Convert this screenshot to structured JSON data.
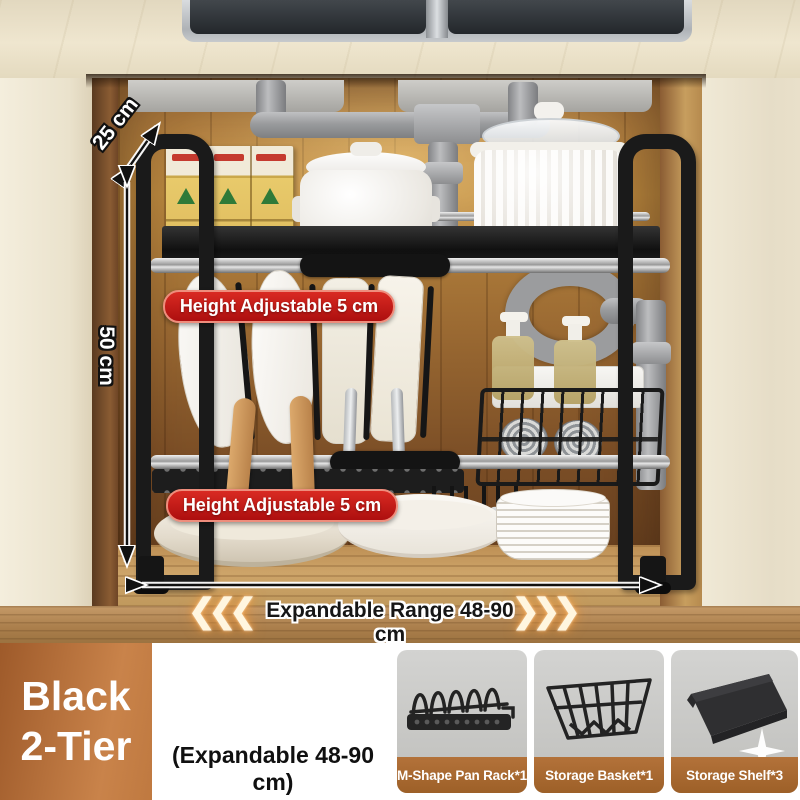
{
  "annotations": {
    "depth_label": "25 cm",
    "height_label": "50 ccm_fix",
    "tier1_badge": "Height Adjustable 5 cm",
    "tier2_badge": "Height Adjustable 5 cm",
    "expand_label": "Expandable Range 48-90 cm",
    "chevrons_left": "❮❮❮",
    "chevrons_right": "❯❯❯",
    "badge_color": "#c41d1c",
    "glow_color": "#f5b267"
  },
  "footer": {
    "variant_line1": "Black",
    "variant_line2": "2-Tier",
    "variant_bg_color": "#b06a35",
    "note": "(Expandable 48-90 cm)",
    "caption_bg_color": "#a96a2f",
    "components": [
      {
        "label": "M-Shape Pan Rack*1",
        "icon": "m-shape-pan-rack-icon"
      },
      {
        "label": "Storage Basket*1",
        "icon": "storage-basket-icon"
      },
      {
        "label": "Storage Shelf*3",
        "icon": "storage-shelf-icon"
      }
    ]
  }
}
